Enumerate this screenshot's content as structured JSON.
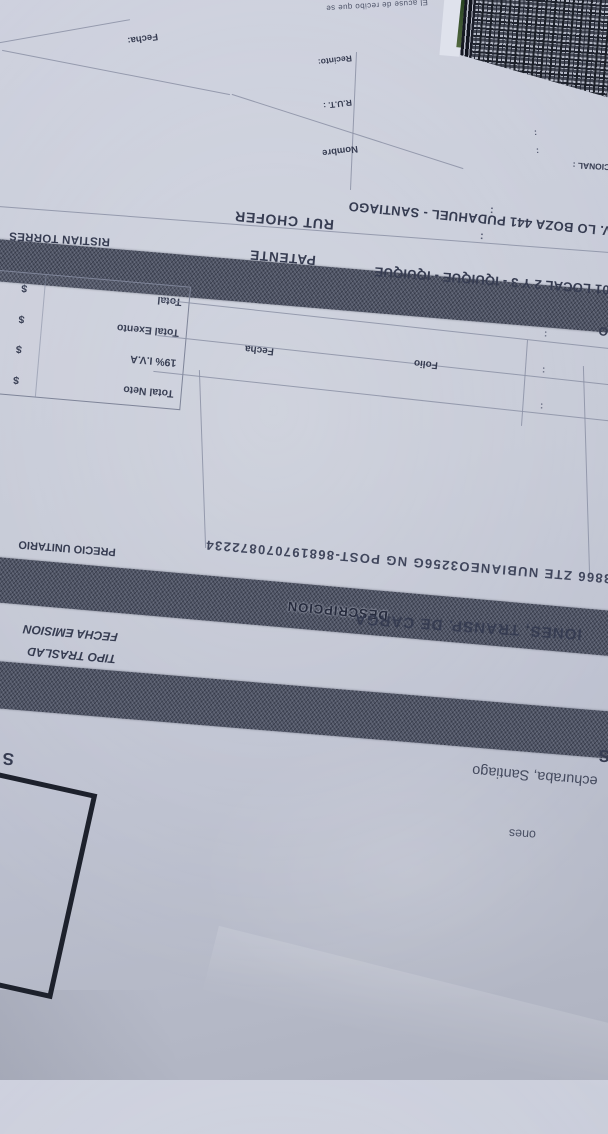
{
  "colors": {
    "paper": "#c6cad7",
    "band": "#4f5465",
    "ink": "#3b4156",
    "box_border": "#1d212c"
  },
  "receipt_box": {
    "legal_fragment": "El acuse de recibo que se",
    "nombre_label": "Nombre",
    "rut_label": "R.U.T. :",
    "recinto_label": "Recinto:",
    "fecha_label": "Fecha:",
    "colon": ":"
  },
  "header_fragments": {
    "opcional_label": "PCIONAL :",
    "colon": ":",
    "o_fragment": "O"
  },
  "transport": {
    "address": "V. LO BOZA 441 PUDAHUEL - SANTIAGO",
    "driver_name": "RISTIAN TORRES",
    "rut_chofer_label": "RUT CHOFER",
    "patente_label": "PATENTE",
    "branch_line": "01 LOCAL 2 Y 3 - IQUIQUE - IQUIQUE",
    "colon": ":"
  },
  "totals": {
    "currency": "$",
    "rows": [
      {
        "label": "Total Neto"
      },
      {
        "label": "19% I.V.A"
      },
      {
        "label": "Total Exento"
      },
      {
        "label": "Total"
      }
    ]
  },
  "folio_section": {
    "fecha_label": "Fecha",
    "folio_label": "Folio"
  },
  "items_table": {
    "description_header": "DESCRIPCION",
    "unit_price_header": "PRECIO UNITARIO",
    "item_line": "3866 ZTE NUBIANEO3256G NG POST-868197070872234"
  },
  "issuer": {
    "giro_fragment": "IONES, TRANSP. DE CARGA",
    "fecha_emision_label": "FECHA EMISION",
    "tipo_traslado_label": "TIPO TRASLAD",
    "company_s_left": "S",
    "company_s_right": "S",
    "city_fragment": "echuraba, Santiago",
    "ones_fragment": "ones"
  }
}
